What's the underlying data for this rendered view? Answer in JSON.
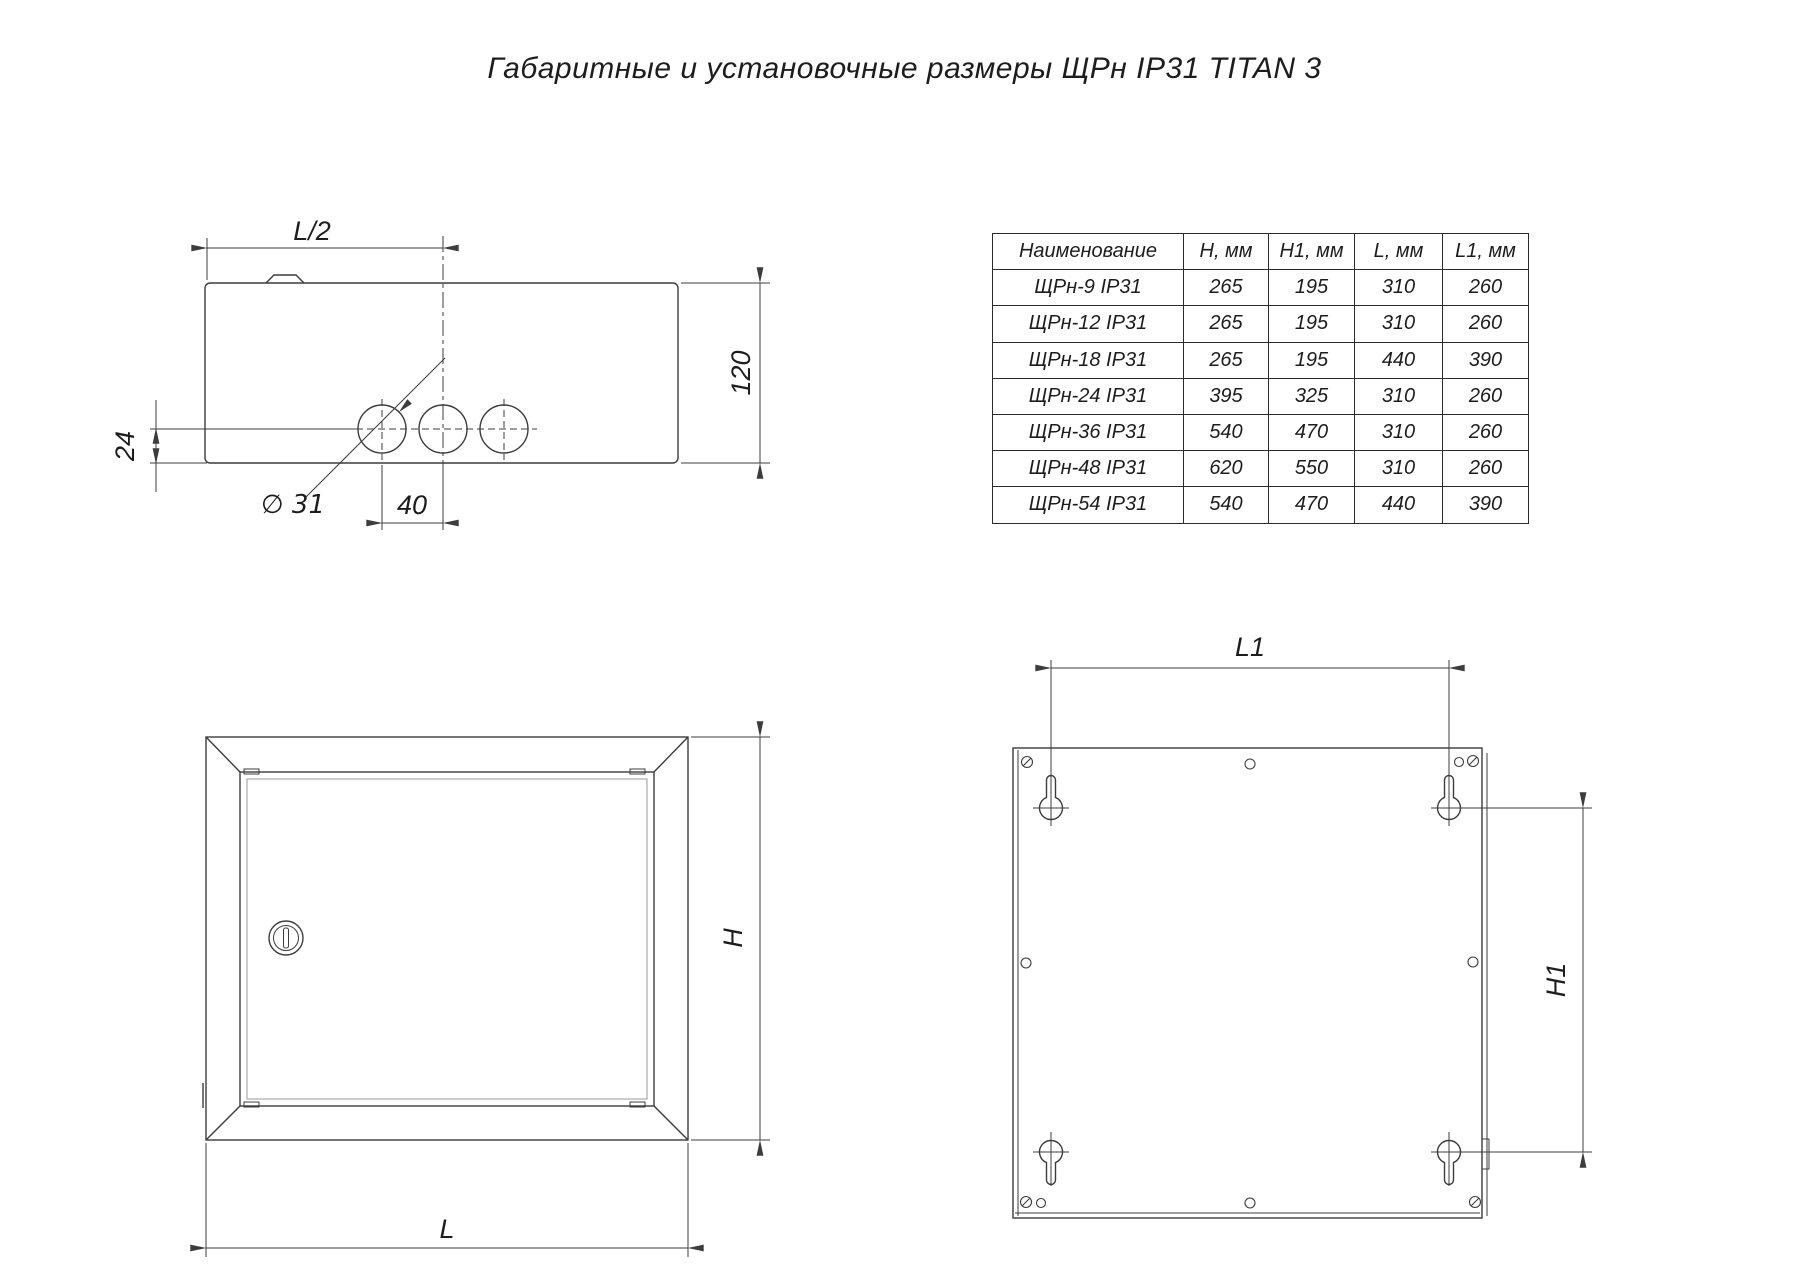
{
  "title": "Габаритные и установочные размеры ЩРн IP31 TITAN 3",
  "table": {
    "headers": [
      "Наименование",
      "H, мм",
      "H1, мм",
      "L, мм",
      "L1, мм"
    ],
    "rows": [
      {
        "name": "ЩРн-9 IP31",
        "h": "265",
        "h1": "195",
        "l": "310",
        "l1": "260"
      },
      {
        "name": "ЩРн-12 IP31",
        "h": "265",
        "h1": "195",
        "l": "310",
        "l1": "260"
      },
      {
        "name": "ЩРн-18 IP31",
        "h": "265",
        "h1": "195",
        "l": "440",
        "l1": "390"
      },
      {
        "name": "ЩРн-24 IP31",
        "h": "395",
        "h1": "325",
        "l": "310",
        "l1": "260"
      },
      {
        "name": "ЩРн-36 IP31",
        "h": "540",
        "h1": "470",
        "l": "310",
        "l1": "260"
      },
      {
        "name": "ЩРн-48 IP31",
        "h": "620",
        "h1": "550",
        "l": "310",
        "l1": "260"
      },
      {
        "name": "ЩРн-54 IP31",
        "h": "540",
        "h1": "470",
        "l": "440",
        "l1": "390"
      }
    ]
  },
  "labels": {
    "half_width": "L/2",
    "depth": "120",
    "knockout_offset": "24",
    "knockout_dia": "∅ 31",
    "knockout_spacing": "40",
    "front_height": "H",
    "front_width": "L",
    "mount_width": "L1",
    "mount_height": "H1"
  },
  "colors": {
    "line": "#3c3c3c",
    "thin": "#8d8d8d",
    "text": "#1d1d1d"
  }
}
